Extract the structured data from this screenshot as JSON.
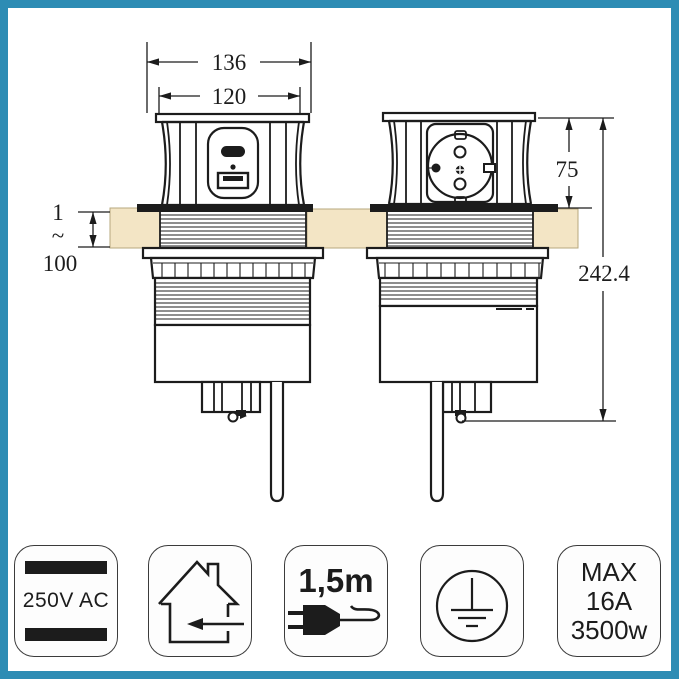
{
  "colors": {
    "frame": "#2d8cb4",
    "board": "#f3e5c5",
    "board_edge": "#b7a87e",
    "line": "#1c1c1c",
    "badge_border": "#3b3b3b",
    "badge_bg": "#fdfdfd"
  },
  "diagram": {
    "dimensions": {
      "cap_width": "136",
      "body_width": "120",
      "above_desk_height": "75",
      "total_height": "242.4",
      "desk_thickness_min": "1",
      "desk_thickness_tilde": "~",
      "desk_thickness_max": "100"
    }
  },
  "badges": [
    {
      "id": "voltage-rating",
      "label": "250V AC",
      "icon": "double-insulation-bars-icon"
    },
    {
      "id": "indoor-use",
      "icon": "house-indoor-use-icon"
    },
    {
      "id": "cable-length",
      "label": "1,5m",
      "icon": "plug-with-cable-icon"
    },
    {
      "id": "earthed",
      "icon": "earth-ground-icon"
    },
    {
      "id": "max-load",
      "lines": [
        "MAX",
        "16A",
        "3500w"
      ]
    }
  ]
}
